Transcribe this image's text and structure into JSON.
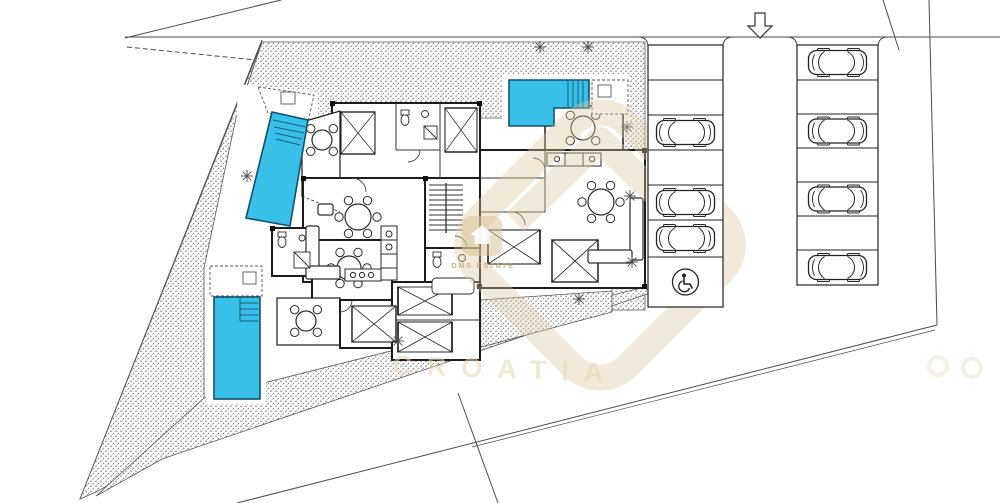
{
  "page": {
    "kind": "architectural-site-plan",
    "background": "#ffffff"
  },
  "watermark": {
    "brand": "DMS ESTATE",
    "brand_icon": "house-icon",
    "country": "CROATIA",
    "color": "#d9c49c"
  },
  "site": {
    "entrance_arrow_icon": "down-arrow-icon",
    "garden_texture": "gravel-stipple",
    "tree_icon": "tree-icon",
    "tree_count": 8
  },
  "pools": {
    "count": 3,
    "color": "#38c0e8",
    "border": "#14506b",
    "items": [
      {
        "name": "pool-top-left",
        "shape": "slanted-rectangle",
        "steps": true
      },
      {
        "name": "pool-top-center",
        "shape": "l-shape",
        "steps": true
      },
      {
        "name": "pool-bottom-left",
        "shape": "rectangle",
        "steps": true
      }
    ]
  },
  "parking": {
    "car_icon": "car-top-view-icon",
    "accessible_icon": "wheelchair-icon",
    "left_column": [
      "empty",
      "empty",
      "car",
      "empty",
      "car",
      "car",
      "accessible"
    ],
    "right_column": [
      "car",
      "empty",
      "car",
      "empty",
      "car",
      "empty",
      "car"
    ]
  },
  "buildings": {
    "count": 2,
    "furniture": [
      "double-bed",
      "dining-table",
      "sofa",
      "kitchen-counter",
      "staircase",
      "bathroom-fixtures",
      "terrace-table"
    ]
  }
}
